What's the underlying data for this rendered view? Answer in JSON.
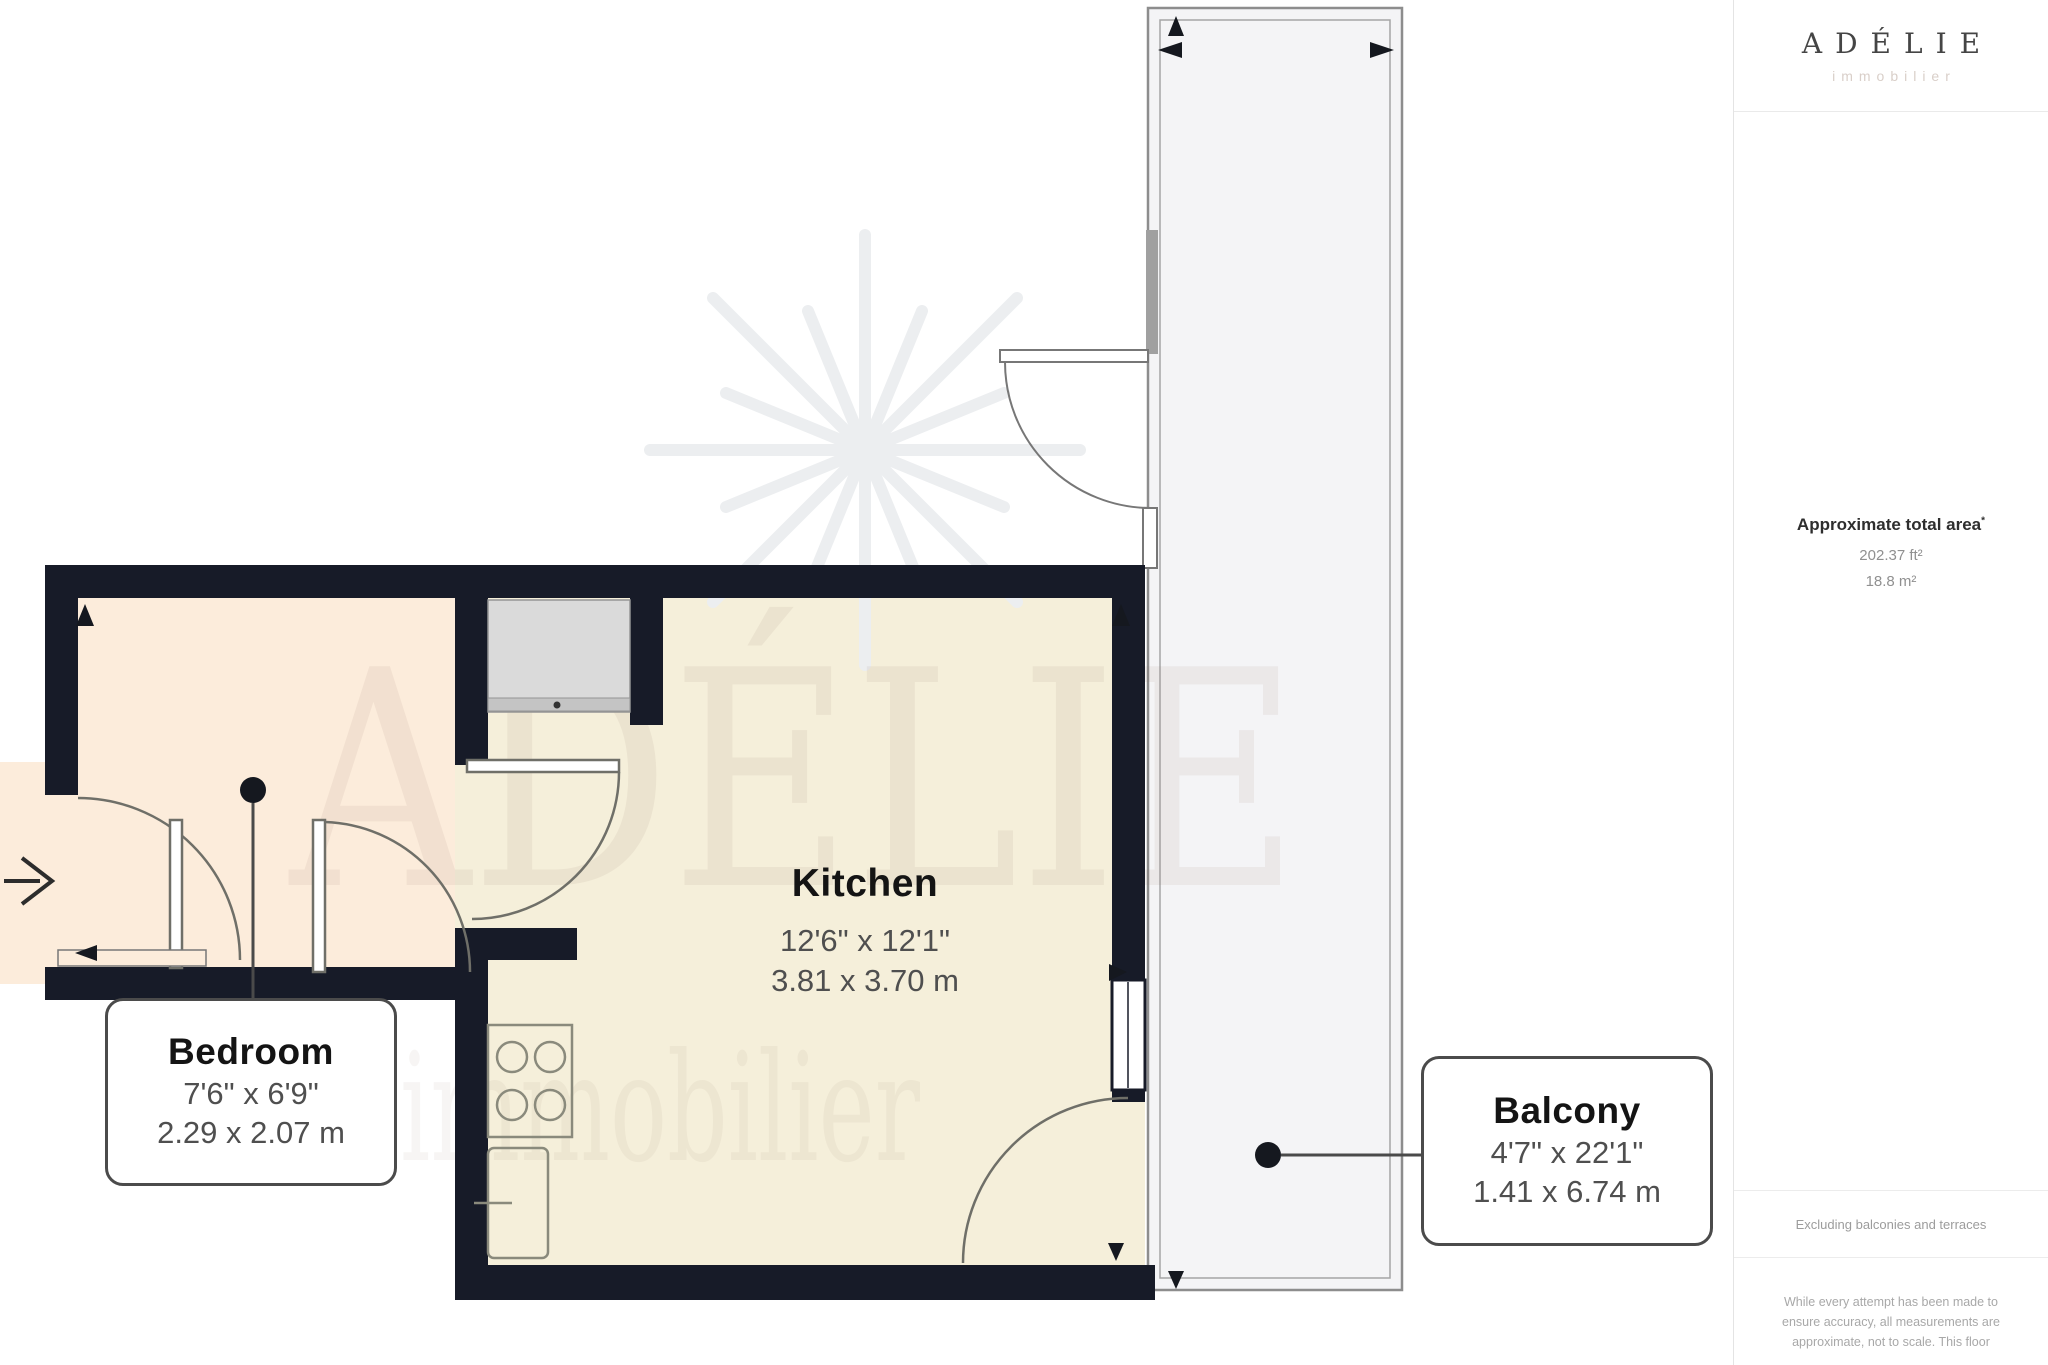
{
  "plan": {
    "watermark": {
      "brand": "ADÉLIE",
      "subbrand": "immobilier"
    },
    "labels": {
      "bedroom": {
        "name": "Bedroom",
        "imperial": "7'6\" x 6'9\"",
        "metric": "2.29 x 2.07 m"
      },
      "kitchen": {
        "name": "Kitchen",
        "imperial": "12'6\" x 12'1\"",
        "metric": "3.81 x 3.70 m"
      },
      "balcony": {
        "name": "Balcony",
        "imperial": "4'7\" x 22'1\"",
        "metric": "1.41 x 6.74 m"
      }
    }
  },
  "sidebar": {
    "logo": {
      "brand": "ADÉLIE",
      "subbrand": "immobilier"
    },
    "area": {
      "title": "Approximate total area",
      "marker": "*",
      "imperial": "202.37 ft²",
      "metric": "18.8 m²"
    },
    "exclusion": "Excluding balconies and terraces",
    "disclaimer": "While every attempt has been made to ensure accuracy, all measurements are approximate, not to scale. This floor"
  },
  "colors": {
    "wall": "#171b28",
    "bedroom_floor": "#fcecdb",
    "kitchen_floor": "#f5efda",
    "balcony_floor": "#f4f4f6",
    "label_border": "#4b4b4b",
    "dim_text": "#4f4f4f",
    "logo_text": "#454545",
    "logo_sub": "#d9cfc9"
  }
}
